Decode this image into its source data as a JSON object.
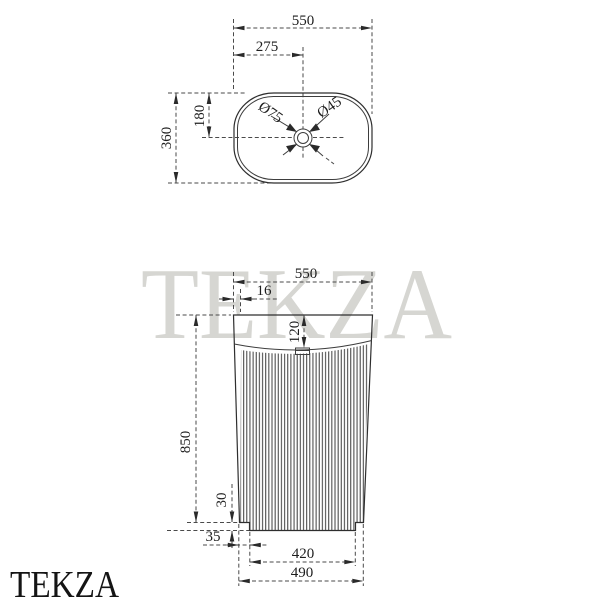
{
  "watermarks": {
    "center": "TEKZA",
    "corner": "TEKZA",
    "color_center": "#d6d6d2",
    "color_corner": "#141414"
  },
  "top_view": {
    "overall_width_mm": "550",
    "drain_offset_mm": "275",
    "overall_depth_mm": "360",
    "drain_center_depth_mm": "180",
    "drain_diameter": "Ø75",
    "faucet_hole_diameter": "Ø45"
  },
  "front_view": {
    "overall_width_mm": "550",
    "wall_thickness_mm": "16",
    "rim_height_mm": "120",
    "overall_height_mm": "850",
    "plinth_height_mm": "30",
    "base_inset_mm": "35",
    "base_width_mm": "420",
    "lower_body_width_mm": "490"
  }
}
